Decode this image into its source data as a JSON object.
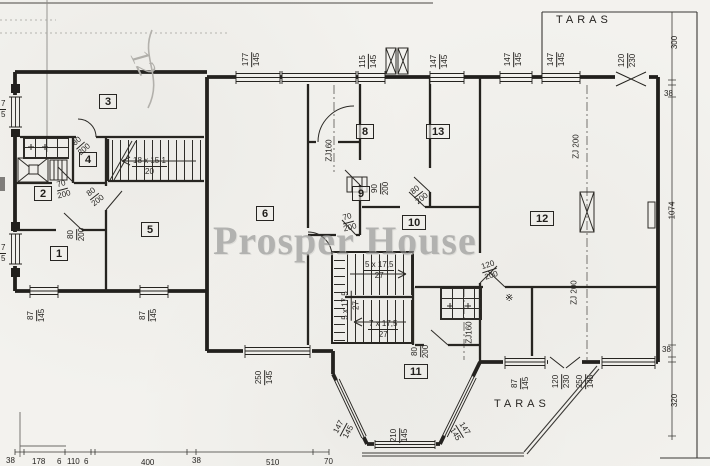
{
  "watermark": "Prosper House",
  "terrace_top_label": "TARAS",
  "terrace_bottom_label": "TARAS",
  "handwritten_note": "12",
  "pantry_symbol": "※",
  "rooms": [
    {
      "n": "1"
    },
    {
      "n": "2"
    },
    {
      "n": "3"
    },
    {
      "n": "4"
    },
    {
      "n": "5"
    },
    {
      "n": "6"
    },
    {
      "n": "8"
    },
    {
      "n": "9"
    },
    {
      "n": "10"
    },
    {
      "n": "11"
    },
    {
      "n": "12"
    },
    {
      "n": "13"
    }
  ],
  "window_dims": [
    {
      "w": "177",
      "h": "145"
    },
    {
      "w": "115",
      "h": "145"
    },
    {
      "w": "147",
      "h": "145"
    },
    {
      "w": "147",
      "h": "145"
    },
    {
      "w": "147",
      "h": "145"
    },
    {
      "w": "120",
      "h": "230"
    },
    {
      "w": "87",
      "h": "145"
    },
    {
      "w": "87",
      "h": "145"
    },
    {
      "w": "250",
      "h": "145"
    },
    {
      "w": "147",
      "h": "145"
    },
    {
      "w": "210",
      "h": "145"
    },
    {
      "w": "147",
      "h": "145"
    },
    {
      "w": "87",
      "h": "145"
    },
    {
      "w": "120",
      "h": "230"
    },
    {
      "w": "250",
      "h": "145"
    }
  ],
  "door_dims": [
    {
      "w": "70",
      "h": "200"
    },
    {
      "w": "80",
      "h": "200"
    },
    {
      "w": "80",
      "h": "200"
    },
    {
      "w": "80",
      "h": "200"
    },
    {
      "w": "70",
      "h": "200"
    },
    {
      "w": "90",
      "h": "200"
    },
    {
      "w": "80",
      "h": "200"
    },
    {
      "w": "80",
      "h": "200"
    },
    {
      "w": "120",
      "h": "200"
    }
  ],
  "stair_dims": {
    "flight1": {
      "steps": "18 x 15,1",
      "width": "20"
    },
    "flight2a": {
      "steps": "5 x 17,5",
      "width": "27"
    },
    "flight2b": {
      "steps": "5 x 17,5",
      "width": "27"
    },
    "flight2c": {
      "steps": "7 x 17,5",
      "width": "27"
    }
  },
  "axis_labels": [
    {
      "t": "ZJ160"
    },
    {
      "t": "ZJ 200"
    },
    {
      "t": "ZJ160"
    },
    {
      "t": "ZJ 200"
    }
  ],
  "side_dims": [
    {
      "t": "300"
    },
    {
      "t": "38"
    },
    {
      "t": "1074"
    },
    {
      "t": "38"
    },
    {
      "t": "320"
    }
  ],
  "bottom_dims": [
    {
      "t": "38"
    },
    {
      "t": "178"
    },
    {
      "t": "6"
    },
    {
      "t": "110"
    },
    {
      "t": "6"
    },
    {
      "t": "400"
    },
    {
      "t": "38"
    },
    {
      "t": "510"
    },
    {
      "t": "70"
    }
  ],
  "edge_dims": [
    {
      "w": "7",
      "h": "5"
    },
    {
      "w": "7",
      "h": "5"
    }
  ]
}
